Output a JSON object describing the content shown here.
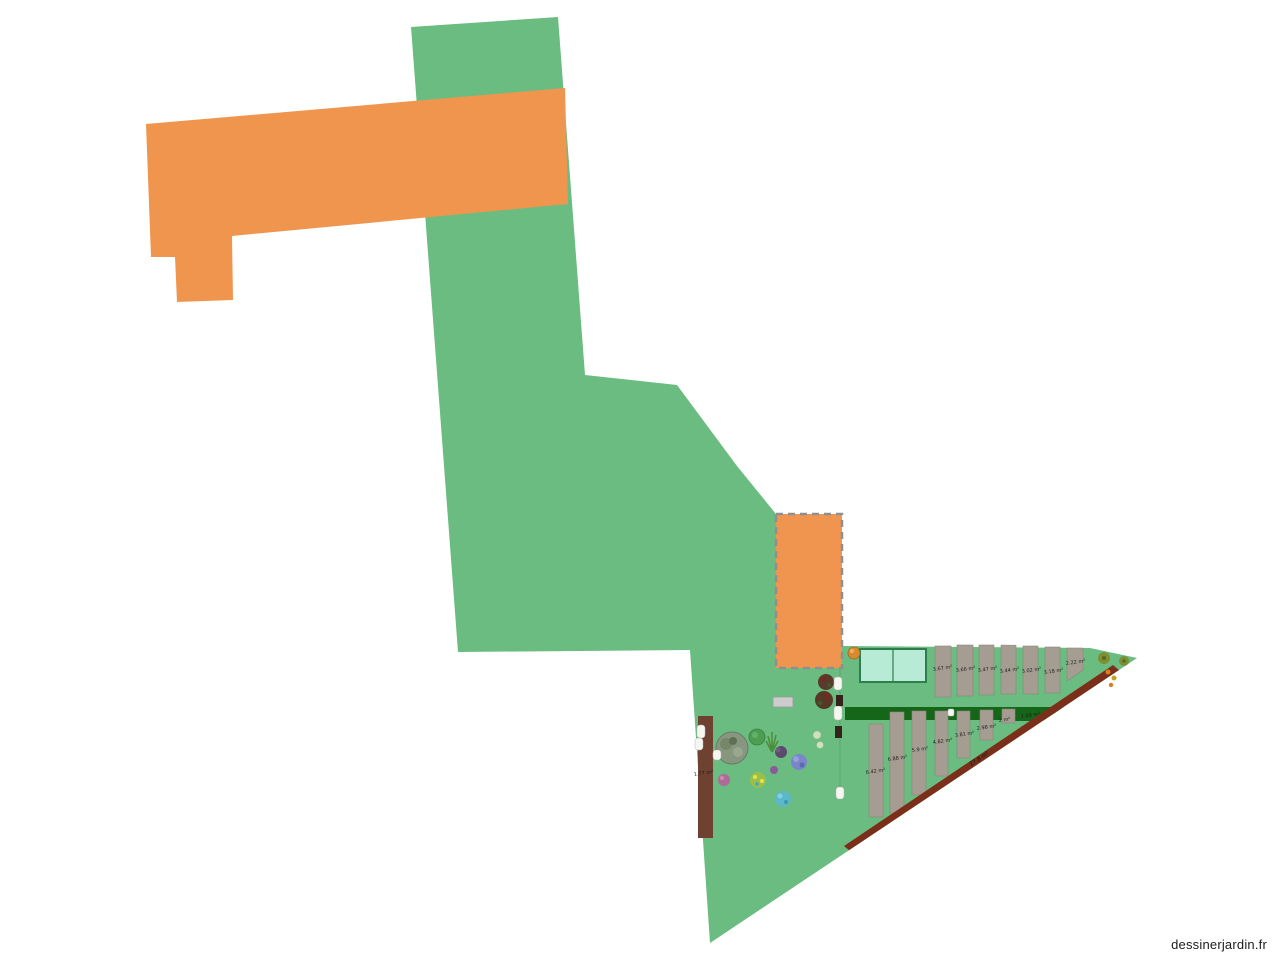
{
  "watermark": {
    "text": "dessinerjardin.fr"
  },
  "colors": {
    "lawn": "#6abc81",
    "building": "#f0954e",
    "annex": "#f0954f",
    "annex_border": "#8f8f8f",
    "bed_fill": "#a59d91",
    "bed_stroke": "#8d8579",
    "path_strip": "#156619",
    "hedge_diagonal": "#7b2f1b",
    "hedge_left": "#6e4130",
    "greenhouse_fill": "#b7ebd6",
    "greenhouse_border": "#2e7d4f",
    "paver": "#cccccc",
    "tag_fill": "#f6f6f1"
  },
  "plan": {
    "beds_top": [
      {
        "area": "3.67 m²"
      },
      {
        "area": "3.66 m²"
      },
      {
        "area": "3.47 m²"
      },
      {
        "area": "3.44 m²"
      },
      {
        "area": "3.02 m²"
      },
      {
        "area": "3.18 m²"
      },
      {
        "area": "2.22 m²"
      }
    ],
    "beds_bottom": [
      {
        "area": "6.42 m²"
      },
      {
        "area": "6.88 m²"
      },
      {
        "area": "5.9 m²"
      },
      {
        "area": "4.82 m²"
      },
      {
        "area": "3.81 m²"
      },
      {
        "area": "2.98 m²"
      },
      {
        "area": "2 m²"
      }
    ],
    "strip_bed": {
      "area": "1.69 m²"
    },
    "hedge_bed": {
      "area": "27.8 m²"
    },
    "left_bed": {
      "area": "1.77 m²"
    }
  }
}
